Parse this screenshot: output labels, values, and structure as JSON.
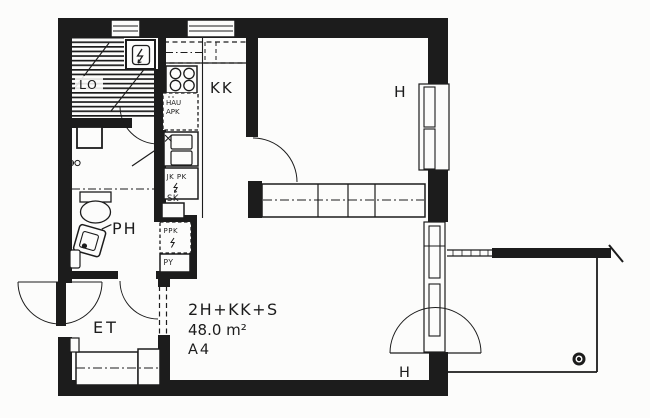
{
  "plan": {
    "colors": {
      "ink": "#1c1c1c",
      "paper": "#fcfcfb"
    },
    "rooms": {
      "sauna": "LO",
      "kitchenette": "KK",
      "bedroom": "H",
      "living_room": "H",
      "bathroom": "PH",
      "entrance": "ET"
    },
    "fixtures": {
      "dishwasher_reservation": [
        "HAU",
        "APK"
      ],
      "fridge_freezer": "JK PK",
      "cleaning_closet": "SK",
      "washing_machine_reservation": "PPK",
      "linen_cupboard": "PY"
    },
    "title_block": {
      "apartment_type": "2H+KK+S",
      "area": "48.0 m²",
      "apartment_number": "A4"
    },
    "icons": {
      "sauna_heater": "lightning-bolt",
      "fridge_electric_mark": "lightning-bolt",
      "washer_electric_mark": "lightning-bolt",
      "floor_drain": "drain-circle"
    }
  }
}
